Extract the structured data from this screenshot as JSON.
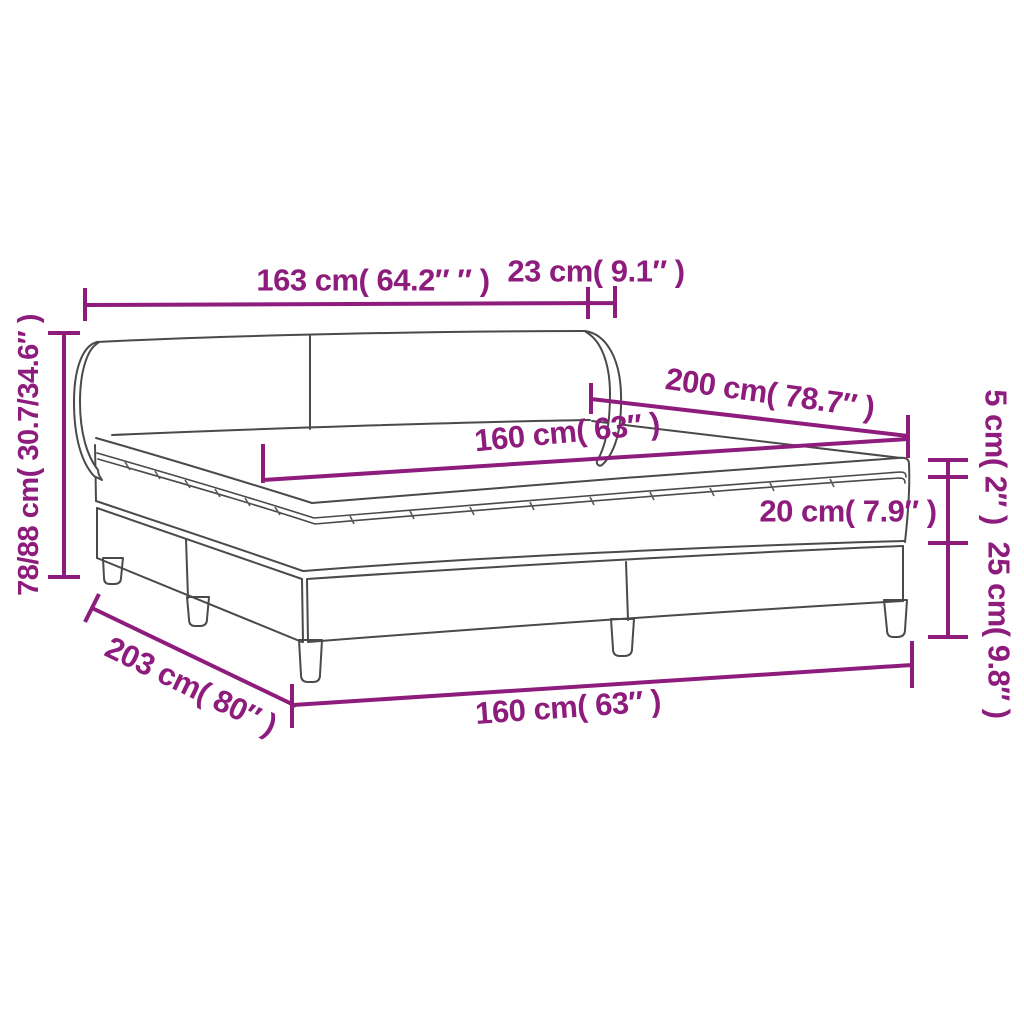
{
  "figure": {
    "type": "line-drawing",
    "subject": "box-spring-bed-with-headboard",
    "parts": [
      "headboard",
      "mattress-topper",
      "mattress",
      "base",
      "legs"
    ]
  },
  "colors": {
    "dimension_accent": "#8d1c7c",
    "drawing_line": "#4a4a4a",
    "background": "#ffffff"
  },
  "dimensions": {
    "headboard_width": {
      "label": "163 cm( 64.2″ ″ )"
    },
    "headboard_depth": {
      "label": "23 cm( 9.1″ )"
    },
    "height_range": {
      "label": "78/88 cm( 30.7/34.6″ )"
    },
    "bed_length": {
      "label": "200 cm( 78.7″ )"
    },
    "mattress_width": {
      "label": "160 cm( 63″ )"
    },
    "topper_height": {
      "label": "5 cm( 2″ )"
    },
    "mattress_height": {
      "label": "20 cm( 7.9″ )"
    },
    "base_height": {
      "label": "25 cm( 9.8″ )"
    },
    "total_length": {
      "label": "203 cm( 80″ )"
    },
    "base_width": {
      "label": "160 cm( 63″ )"
    }
  }
}
